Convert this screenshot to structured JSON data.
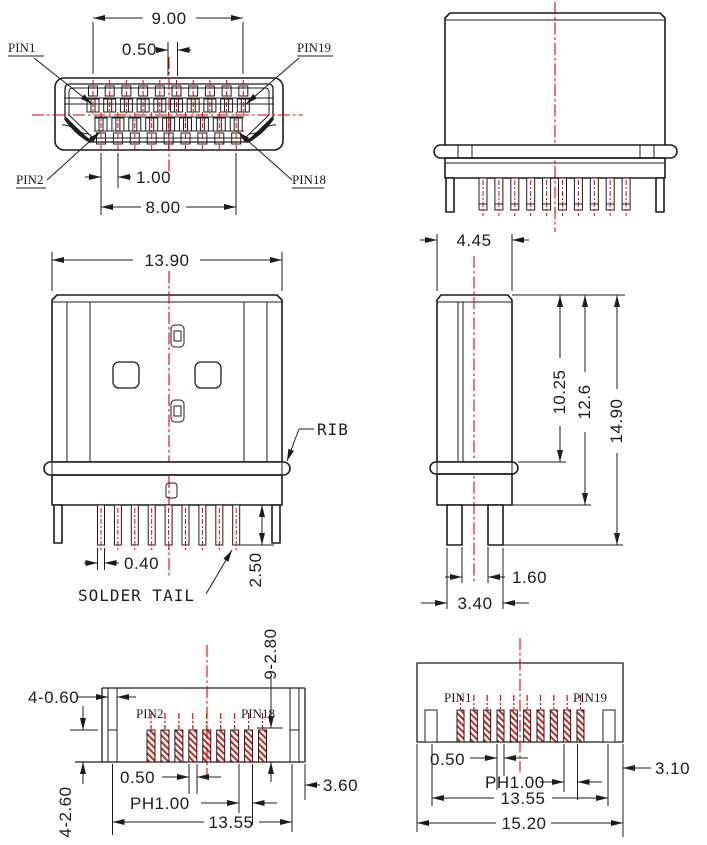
{
  "colors": {
    "line": "#1c1c1c",
    "centerline": "#e60000",
    "hatch": "#c62828",
    "background": "#ffffff"
  },
  "drawing": {
    "front_view": {
      "span_top": "9.00",
      "offset": "0.50",
      "pitch": "1.00",
      "span_bottom": "8.00",
      "pin1": "PIN1",
      "pin19": "PIN19",
      "pin2": "PIN2",
      "pin18": "PIN18",
      "top_contacts": 10,
      "bottom_contacts": 9
    },
    "rear_view": {
      "pins": 10
    },
    "top_view": {
      "width": "13.90",
      "rib": "RIB",
      "solder_tail": "SOLDER TAIL",
      "tail_width": "0.40",
      "tail_length": "2.50",
      "tails": 9
    },
    "side_view": {
      "depth": "4.45",
      "h_rib": "10.25",
      "h_base": "12.6",
      "h_total": "14.90",
      "leg_gap": "1.60",
      "leg_span": "3.40"
    },
    "footprint_bottom": {
      "slots_width": "4-0.60",
      "slots_length": "4-2.60",
      "pads_dim": "9-2.80",
      "pin2": "PIN2",
      "pin18": "PIN18",
      "gap": "0.50",
      "pitch": "PH1.00",
      "span": "13.55",
      "side": "3.60",
      "pads": 9
    },
    "footprint_top": {
      "pin1": "PIN1",
      "pin19": "PIN19",
      "gap": "0.50",
      "pitch": "PH1.00",
      "span": "13.55",
      "width": "15.20",
      "side": "3.10",
      "pads": 10
    }
  }
}
